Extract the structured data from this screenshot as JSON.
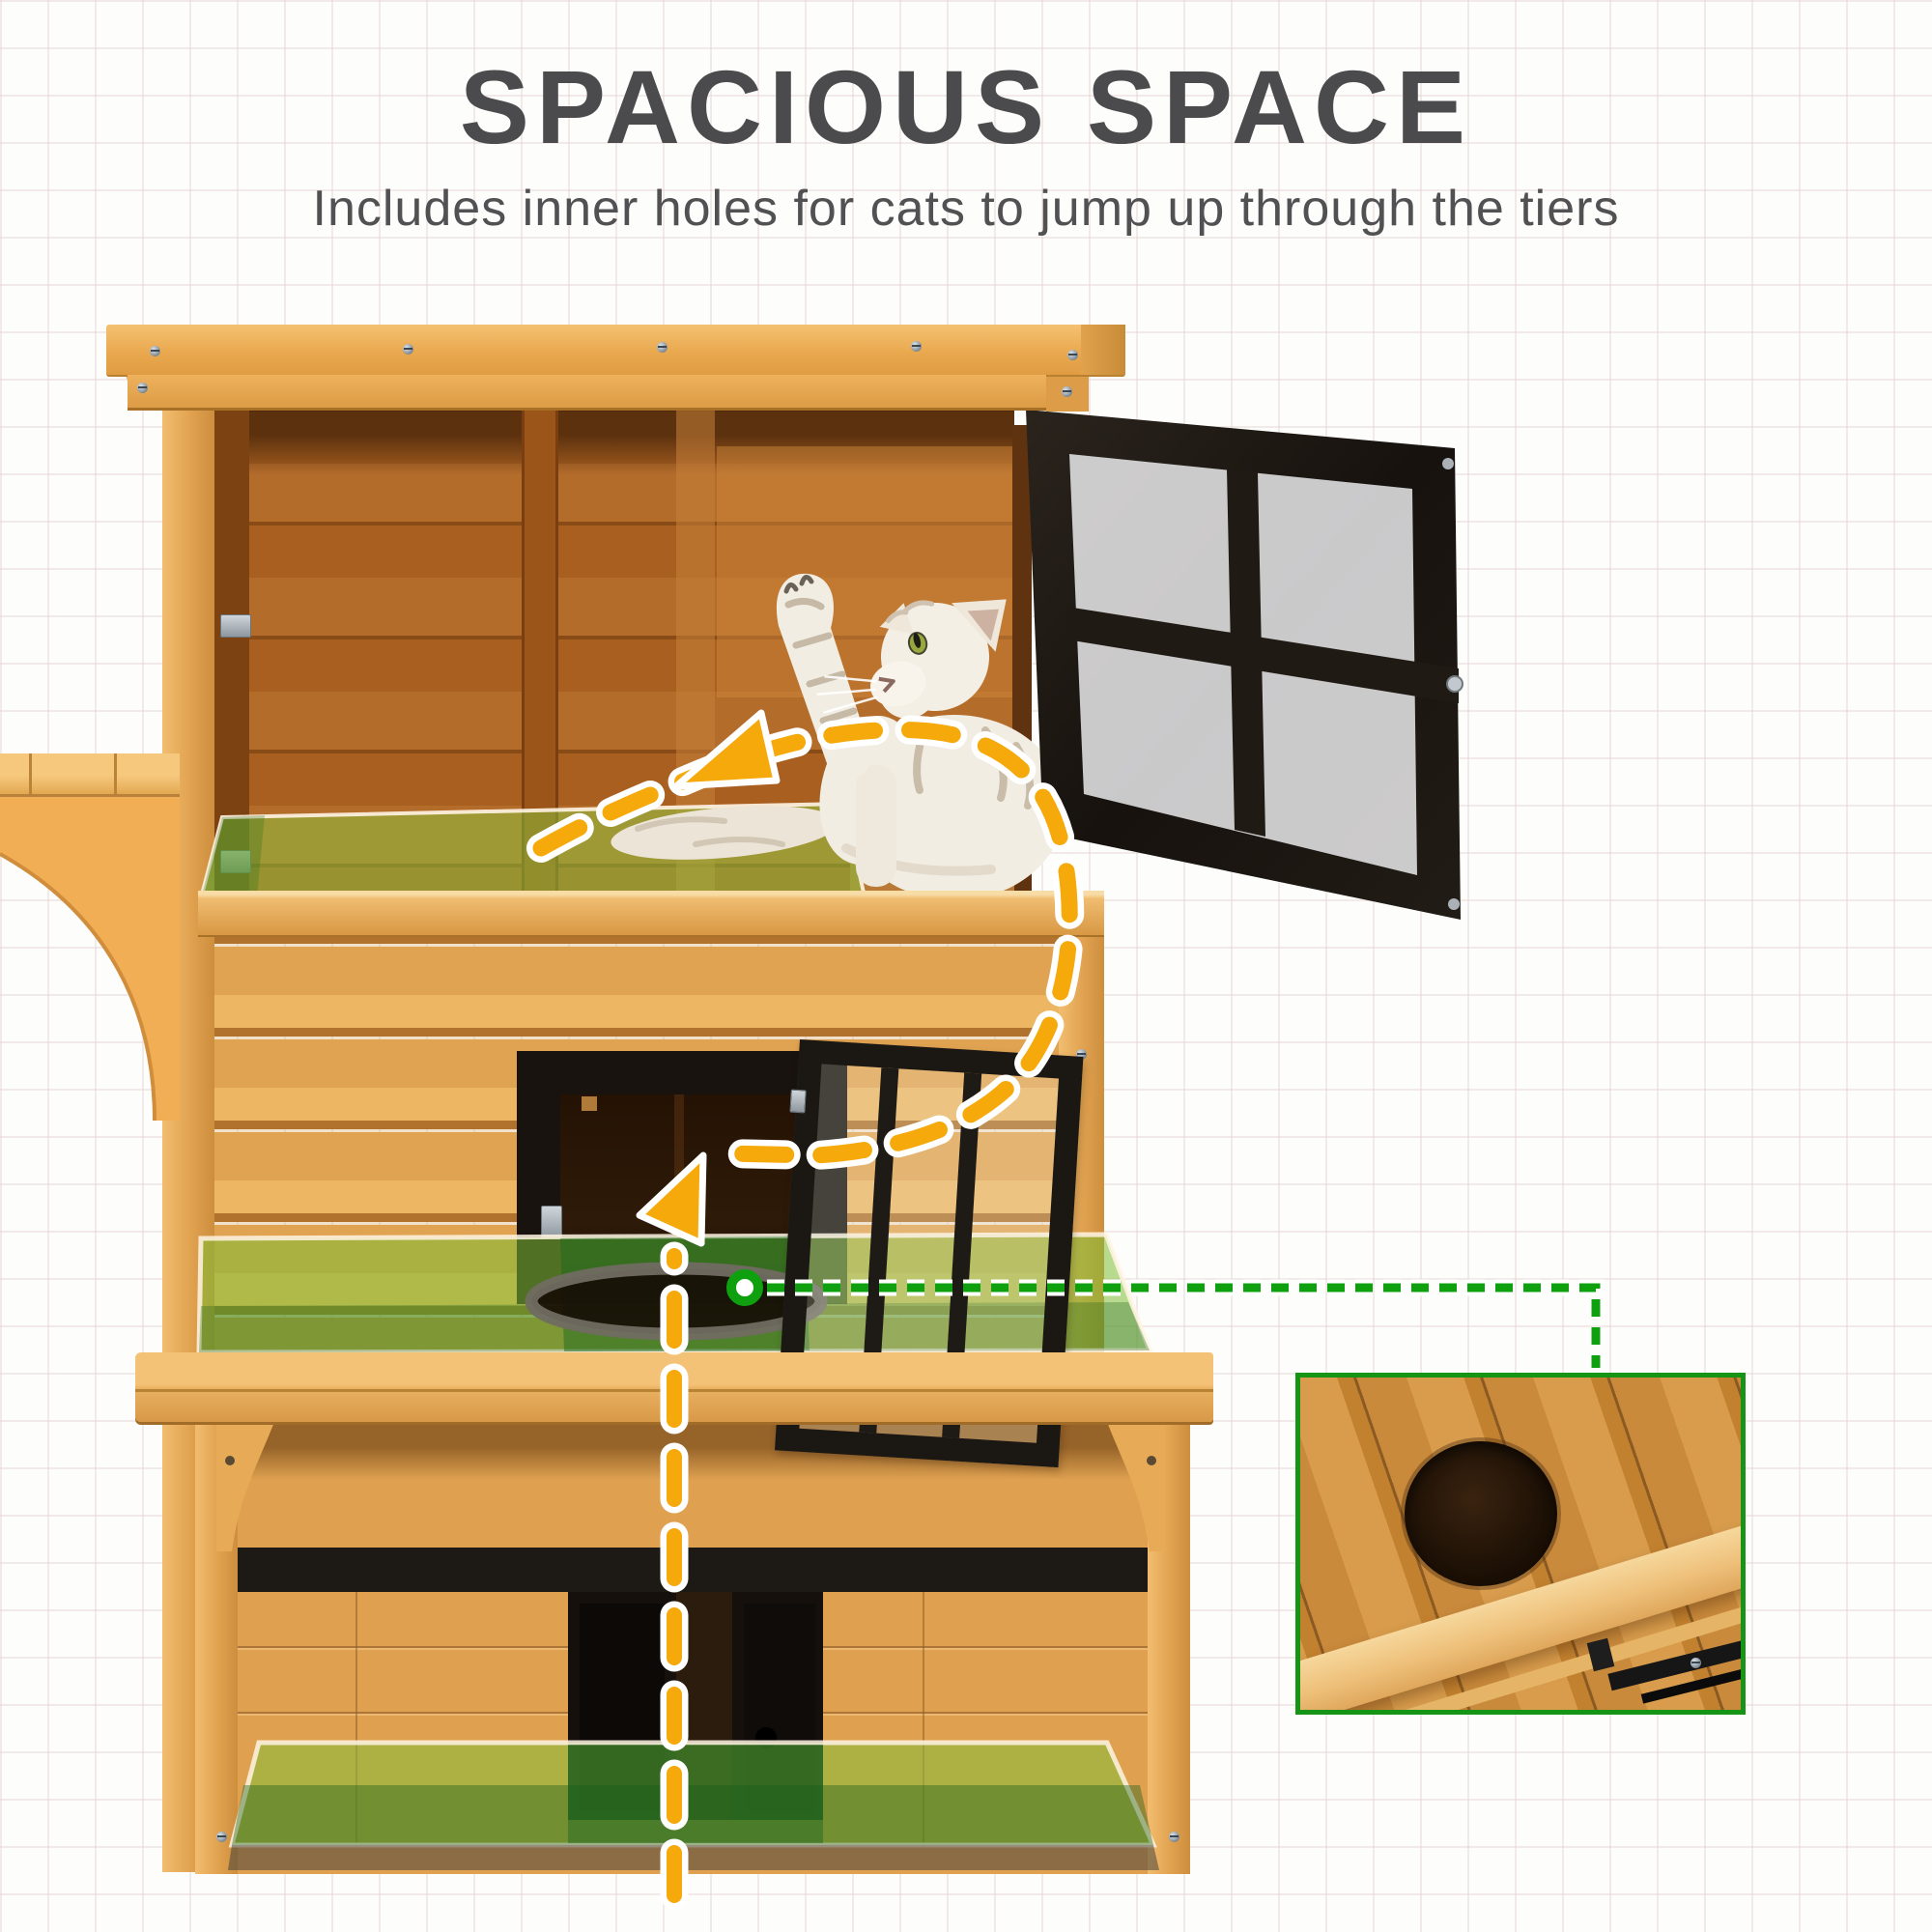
{
  "header": {
    "title": "SPACIOUS SPACE",
    "subtitle": "Includes inner holes for cats to jump up through the tiers"
  },
  "colors": {
    "title-ink": "#4b4b4d",
    "accent-yellow": "#f5a90b",
    "accent-green": "#0fa00f",
    "overlay-green": "rgba(128,190,52,0.55)",
    "inset-border": "#169416",
    "wood-light": "#eab25c",
    "wood-interior": "#a85f20",
    "frame-black": "#1c1713"
  },
  "figure": {
    "subject": "three-tier wooden outdoor cat house",
    "annotations": {
      "jump_path_style": "yellow dashed arrows",
      "floor_highlight_style": "translucent green overlay on each tier floor",
      "hole_callout_style": "green dashed line from inner hole to close-up photo"
    }
  }
}
